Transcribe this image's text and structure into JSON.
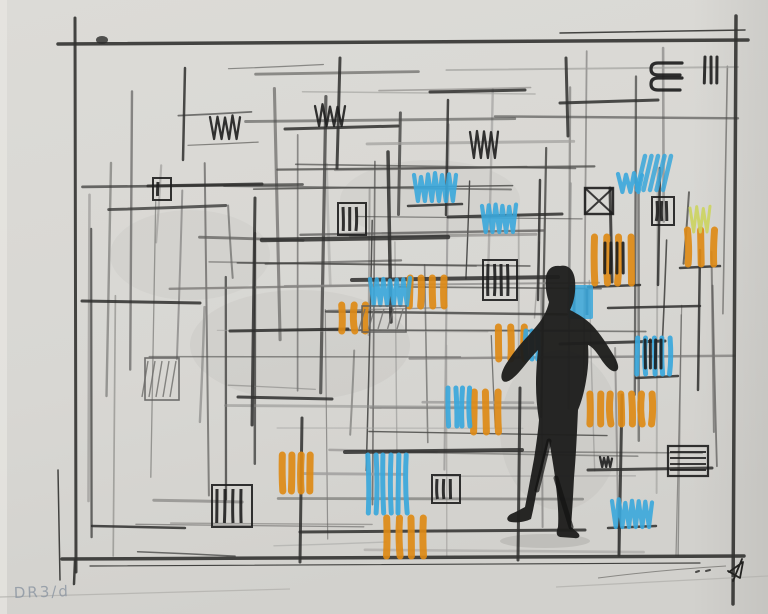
{
  "artwork": {
    "inscription": "DR3/d",
    "palette": {
      "paper": "#d8d7d3",
      "paper_light": "#dedddb",
      "graphite": "#4a4a48",
      "dark": "#1d1d1d",
      "orange": "#dd8a16",
      "blue": "#3aa7db",
      "yellow_green": "#ccd45e",
      "inscription_color": "#8b95a2"
    },
    "figure": {
      "fill": "#1e1e1d",
      "path": "M560,266 C568,264 574,270 575,280 C576,292 574,302 570,310 C578,314 586,319 592,325 C600,333 608,346 614,356 C618,363 620,369 616,371 C611,373 604,364 599,356 C595,350 591,346 588,345 C589,358 588,370 586,381 C584,393 581,403 578,410 C577,432 576,456 574,478 C573,498 572,514 571,527 L578,533 C581,536 579,539 574,538 L560,537 C556,536 556,532 558,527 C559,512 557,494 555,477 C553,463 551,451 549,441 C545,457 541,474 537,489 C535,501 533,511 531,519 C525,522 517,523 511,522 C506,521 506,517 511,514 C516,512 521,509 525,507 C528,492 531,475 534,459 C536,446 538,432 539,420 C537,408 536,396 536,384 C536,372 537,360 538,350 C532,356 526,364 520,371 C514,378 507,384 503,381 C499,377 503,368 508,361 C514,352 521,343 528,336 C533,330 539,324 543,317 C546,312 548,307 549,302 C546,294 545,284 546,276 C548,268 553,265 560,266 Z"
    },
    "marks": [
      {
        "x": 340,
        "y": 303,
        "w": 28,
        "h": 30,
        "kind": "orange-stripes"
      },
      {
        "x": 408,
        "y": 276,
        "w": 38,
        "h": 32,
        "kind": "orange-stripes"
      },
      {
        "x": 280,
        "y": 453,
        "w": 32,
        "h": 40,
        "kind": "orange-stripes"
      },
      {
        "x": 385,
        "y": 516,
        "w": 40,
        "h": 42,
        "kind": "orange-stripes"
      },
      {
        "x": 472,
        "y": 390,
        "w": 28,
        "h": 44,
        "kind": "orange-stripes"
      },
      {
        "x": 496,
        "y": 325,
        "w": 30,
        "h": 36,
        "kind": "orange-stripes"
      },
      {
        "x": 593,
        "y": 235,
        "w": 40,
        "h": 50,
        "kind": "orange-stripes"
      },
      {
        "x": 686,
        "y": 228,
        "w": 30,
        "h": 38,
        "kind": "orange-stripes"
      },
      {
        "x": 588,
        "y": 392,
        "w": 66,
        "h": 34,
        "kind": "orange-stripes"
      },
      {
        "x": 414,
        "y": 173,
        "w": 42,
        "h": 30,
        "kind": "blue-loops"
      },
      {
        "x": 482,
        "y": 204,
        "w": 34,
        "h": 30,
        "kind": "blue-loops"
      },
      {
        "x": 370,
        "y": 277,
        "w": 40,
        "h": 30,
        "kind": "blue-loops"
      },
      {
        "x": 612,
        "y": 499,
        "w": 40,
        "h": 30,
        "kind": "blue-loops"
      },
      {
        "x": 618,
        "y": 172,
        "w": 24,
        "h": 22,
        "kind": "blue-loops"
      },
      {
        "x": 366,
        "y": 453,
        "w": 42,
        "h": 62,
        "kind": "blue-stripes"
      },
      {
        "x": 446,
        "y": 386,
        "w": 26,
        "h": 42,
        "kind": "blue-stripes"
      },
      {
        "x": 524,
        "y": 329,
        "w": 16,
        "h": 32,
        "kind": "blue-stripes"
      },
      {
        "x": 636,
        "y": 336,
        "w": 36,
        "h": 40,
        "kind": "blue-stripes"
      },
      {
        "x": 569,
        "y": 285,
        "w": 24,
        "h": 34,
        "kind": "blue-solid"
      },
      {
        "x": 641,
        "y": 156,
        "w": 32,
        "h": 34,
        "kind": "blue-diag"
      },
      {
        "x": 210,
        "y": 115,
        "w": 30,
        "h": 26,
        "kind": "dark-zigzag"
      },
      {
        "x": 315,
        "y": 104,
        "w": 30,
        "h": 24,
        "kind": "dark-zigzag"
      },
      {
        "x": 470,
        "y": 130,
        "w": 28,
        "h": 30,
        "kind": "dark-zigzag"
      },
      {
        "x": 600,
        "y": 455,
        "w": 12,
        "h": 14,
        "kind": "dark-zigzag"
      },
      {
        "x": 338,
        "y": 203,
        "w": 28,
        "h": 32,
        "kind": "dark-bars-box"
      },
      {
        "x": 483,
        "y": 260,
        "w": 34,
        "h": 40,
        "kind": "dark-bars-box"
      },
      {
        "x": 652,
        "y": 197,
        "w": 22,
        "h": 28,
        "kind": "dark-bars-box"
      },
      {
        "x": 212,
        "y": 485,
        "w": 40,
        "h": 42,
        "kind": "dark-bars-box"
      },
      {
        "x": 432,
        "y": 475,
        "w": 28,
        "h": 28,
        "kind": "dark-bars-box"
      },
      {
        "x": 605,
        "y": 243,
        "w": 22,
        "h": 30,
        "kind": "dark-bars"
      },
      {
        "x": 645,
        "y": 340,
        "w": 20,
        "h": 28,
        "kind": "dark-bars"
      },
      {
        "x": 705,
        "y": 57,
        "w": 16,
        "h": 26,
        "kind": "dark-bars"
      },
      {
        "x": 585,
        "y": 188,
        "w": 28,
        "h": 26,
        "kind": "dark-x-box"
      },
      {
        "x": 648,
        "y": 58,
        "w": 38,
        "h": 34,
        "kind": "dark-loops"
      },
      {
        "x": 153,
        "y": 178,
        "w": 18,
        "h": 22,
        "kind": "dark-small-box"
      },
      {
        "x": 668,
        "y": 446,
        "w": 40,
        "h": 30,
        "kind": "dark-lines-box"
      },
      {
        "x": 96,
        "y": 36,
        "w": 12,
        "h": 8,
        "kind": "dark-blob"
      },
      {
        "x": 145,
        "y": 358,
        "w": 34,
        "h": 42,
        "kind": "pencil-hatch"
      },
      {
        "x": 362,
        "y": 306,
        "w": 44,
        "h": 26,
        "kind": "pencil-hatch"
      },
      {
        "x": 690,
        "y": 206,
        "w": 20,
        "h": 28,
        "kind": "yellow-zigzag"
      }
    ]
  },
  "sketch": {
    "seed": 11,
    "patch_seed": 99,
    "graphite_shades": [
      "#3a3a38",
      "#4a4a48",
      "#5f5e5c",
      "#757472",
      "#8b8a88",
      "#a09f9d"
    ],
    "grid": {
      "cols": [
        90,
        112,
        134,
        158,
        183,
        206,
        230,
        254,
        278,
        302,
        326,
        350,
        374,
        398,
        422,
        446,
        470,
        494,
        518,
        542,
        566,
        590,
        614,
        638,
        662,
        686,
        710,
        726
      ],
      "rows": [
        70,
        94,
        118,
        142,
        166,
        190,
        214,
        238,
        262,
        286,
        310,
        334,
        358,
        382,
        406,
        430,
        454,
        478,
        502,
        526,
        548
      ]
    },
    "bold_strokes": [
      [
        285,
        129,
        398,
        126,
        3
      ],
      [
        148,
        186,
        262,
        184,
        3
      ],
      [
        262,
        240,
        448,
        237,
        4.5
      ],
      [
        448,
        217,
        562,
        214,
        3
      ],
      [
        82,
        301,
        200,
        303,
        3
      ],
      [
        230,
        331,
        348,
        329,
        3
      ],
      [
        352,
        280,
        558,
        277,
        4
      ],
      [
        345,
        452,
        522,
        450,
        4
      ],
      [
        560,
        344,
        665,
        341,
        3
      ],
      [
        588,
        470,
        712,
        468,
        3
      ],
      [
        92,
        526,
        185,
        528,
        2.5
      ],
      [
        430,
        92,
        525,
        90,
        3
      ],
      [
        560,
        103,
        658,
        100,
        3
      ],
      [
        608,
        308,
        700,
        306,
        2.5
      ],
      [
        238,
        397,
        332,
        399,
        3
      ],
      [
        300,
        532,
        585,
        530,
        3
      ],
      [
        408,
        206,
        462,
        204,
        2.5
      ],
      [
        588,
        287,
        640,
        285,
        2.5
      ],
      [
        680,
        268,
        720,
        266,
        2.5
      ],
      [
        636,
        378,
        678,
        376,
        2.5
      ],
      [
        608,
        528,
        656,
        526,
        2.5
      ],
      [
        388,
        152,
        391,
        322,
        3.5
      ],
      [
        340,
        58,
        337,
        168,
        3
      ],
      [
        566,
        58,
        568,
        136,
        3
      ],
      [
        610,
        188,
        612,
        282,
        3
      ],
      [
        255,
        198,
        252,
        425,
        3
      ],
      [
        302,
        418,
        300,
        562,
        3
      ],
      [
        520,
        388,
        518,
        560,
        3
      ],
      [
        660,
        168,
        658,
        285,
        2.5
      ],
      [
        185,
        68,
        183,
        160,
        2.5
      ],
      [
        448,
        100,
        446,
        215,
        2.5
      ],
      [
        700,
        250,
        698,
        390,
        2.5
      ],
      [
        622,
        395,
        619,
        555,
        3
      ],
      [
        540,
        180,
        538,
        300,
        2.5
      ]
    ],
    "frame": [
      [
        75,
        18,
        76,
        572,
        3
      ],
      [
        58,
        44,
        748,
        40,
        3.5
      ],
      [
        736,
        16,
        733,
        604,
        3.5
      ],
      [
        62,
        559,
        744,
        556,
        3.5
      ],
      [
        90,
        566,
        700,
        563,
        1.2
      ],
      [
        560,
        33,
        745,
        30,
        1.5
      ],
      [
        58,
        470,
        60,
        580,
        1.5
      ],
      [
        75,
        560,
        74,
        584,
        2.5
      ]
    ],
    "edge_lines": [
      [
        0,
        597,
        290,
        589
      ],
      [
        556,
        587,
        768,
        576
      ]
    ],
    "smudges": [
      [
        300,
        345,
        110,
        55,
        0.05
      ],
      [
        190,
        255,
        80,
        45,
        0.04
      ],
      [
        430,
        200,
        90,
        40,
        0.04
      ],
      [
        560,
        430,
        60,
        80,
        0.05
      ],
      [
        545,
        541,
        45,
        7,
        0.15
      ]
    ],
    "signature": {
      "curve": "M598,578 Q660,570 726,566",
      "dots": "M696,572 l3,-1 M706,571 l4,-1",
      "monogram": "M742,559 L733,581 M729,572 L743,562 L740,578 L728,571"
    }
  }
}
